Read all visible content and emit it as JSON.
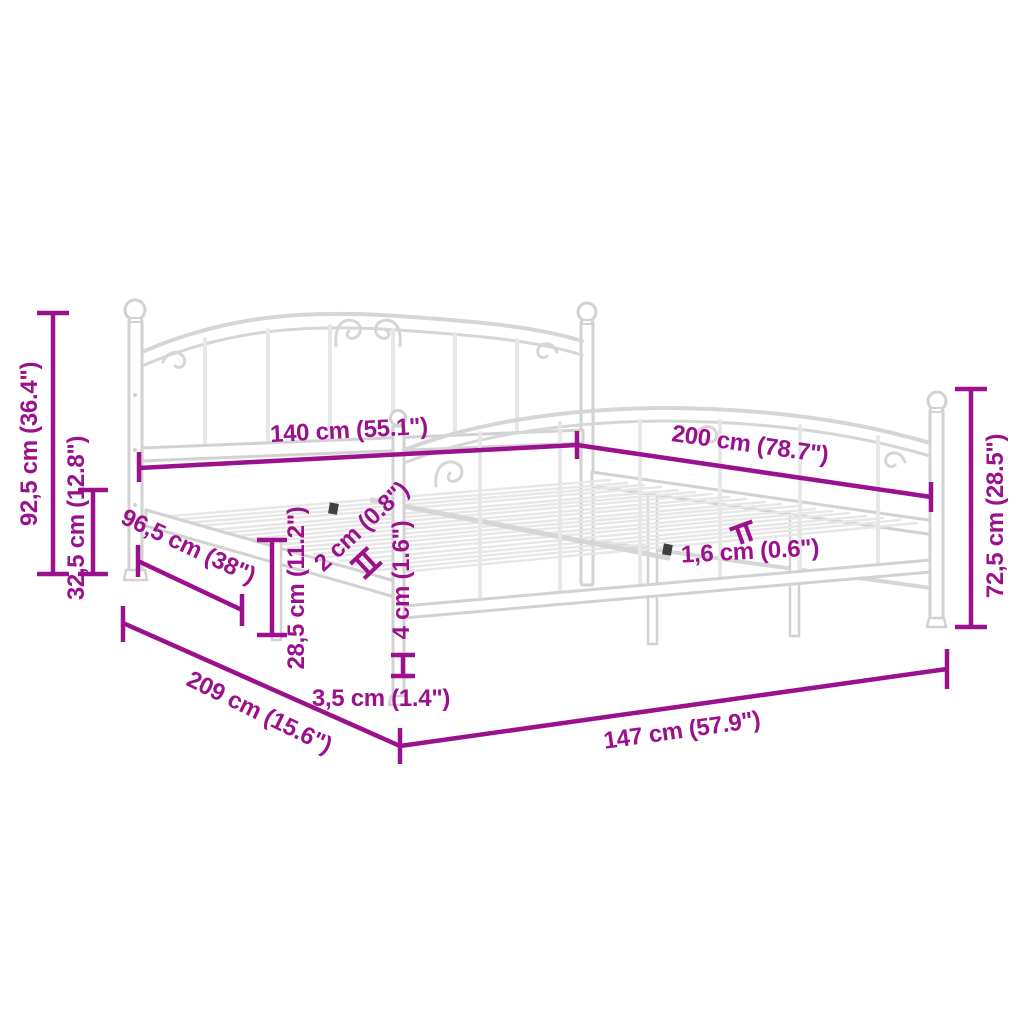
{
  "figure": {
    "description": "Perspective line drawing of a white metal bed frame (headboard, footboard, slatted base) annotated with magenta dimension lines",
    "background_color": "#ffffff",
    "annotation_color": "#9b108c",
    "frame_color": "#d2d2d2"
  },
  "dims": {
    "d92_5": "92,5 cm (36.4\")",
    "d32_5": "32,5 cm (12.8\")",
    "d96_5": "96,5 cm (38\")",
    "d140": "140 cm (55.1\")",
    "d200": "200 cm (78.7\")",
    "d72_5": "72,5 cm (28.5\")",
    "d28_5": "28,5 cm (11.2\")",
    "d2": "2 cm (0.8\")",
    "d1_6": "1,6 cm (0.6\")",
    "d4": "4 cm (1.6\")",
    "d3_5": "3,5 cm (1.4\")",
    "d209": "209 cm (15.6\")",
    "d147": "147 cm (57.9\")"
  }
}
